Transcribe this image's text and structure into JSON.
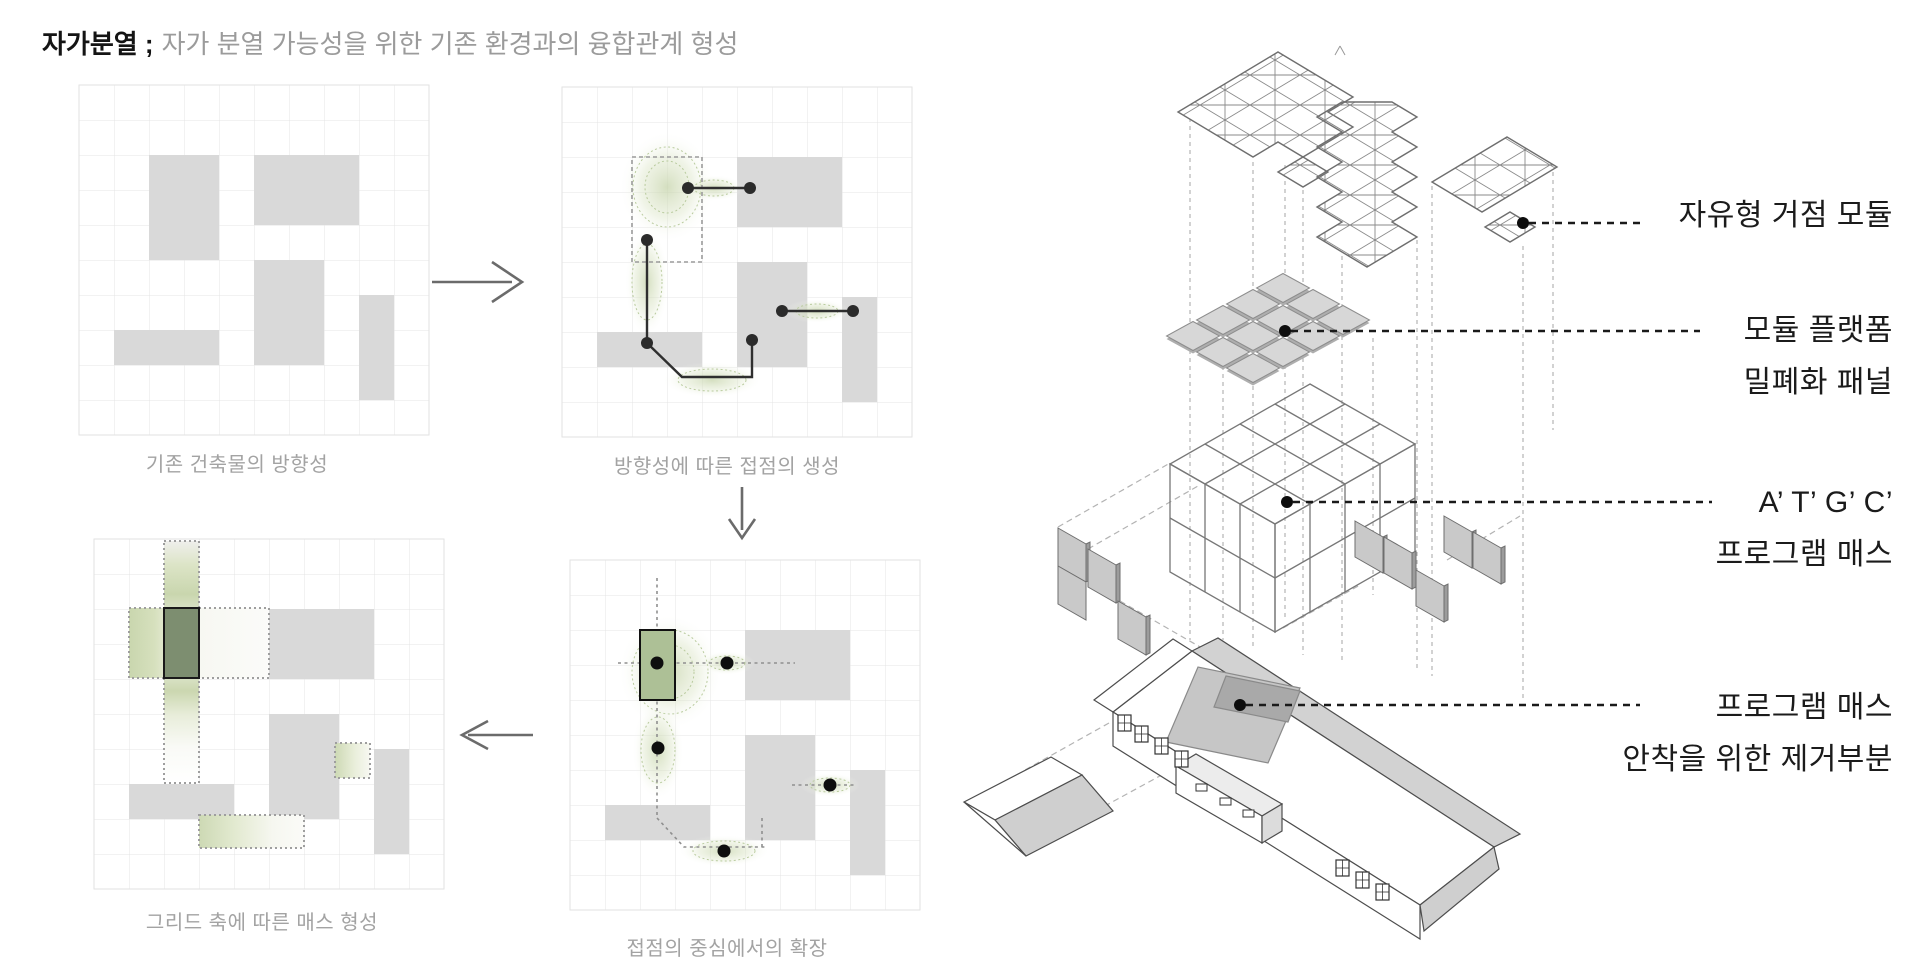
{
  "title": {
    "term": "자가분열 ;",
    "subtitle": "자가 분열 가능성을 위한 기존 환경과의 융합관계 형성"
  },
  "process": {
    "step1": {
      "caption": "기존 건축물의 방향성"
    },
    "step2": {
      "caption": "방향성에 따른 접점의 생성"
    },
    "step3": {
      "caption": "그리드 축에 따른 매스 형성"
    },
    "step4": {
      "caption": "접점의 중심에서의 확장"
    }
  },
  "exploded_axon": {
    "labels": {
      "module": "자유형 거점 모듈",
      "platform_line1": "모듈 플랫폼",
      "platform_line2": "밀폐화 패널",
      "program_line1": "A’ T’ G’ C’",
      "program_line2": "프로그램 매스",
      "removal_line1": "프로그램 매스",
      "removal_line2": "안착을 위한 제거부분"
    }
  },
  "colors": {
    "block_gray": "#d9d9d9",
    "accent_green": "#adc096",
    "dark_green": "#7d8e70",
    "leader_black": "#1a1a1a"
  }
}
